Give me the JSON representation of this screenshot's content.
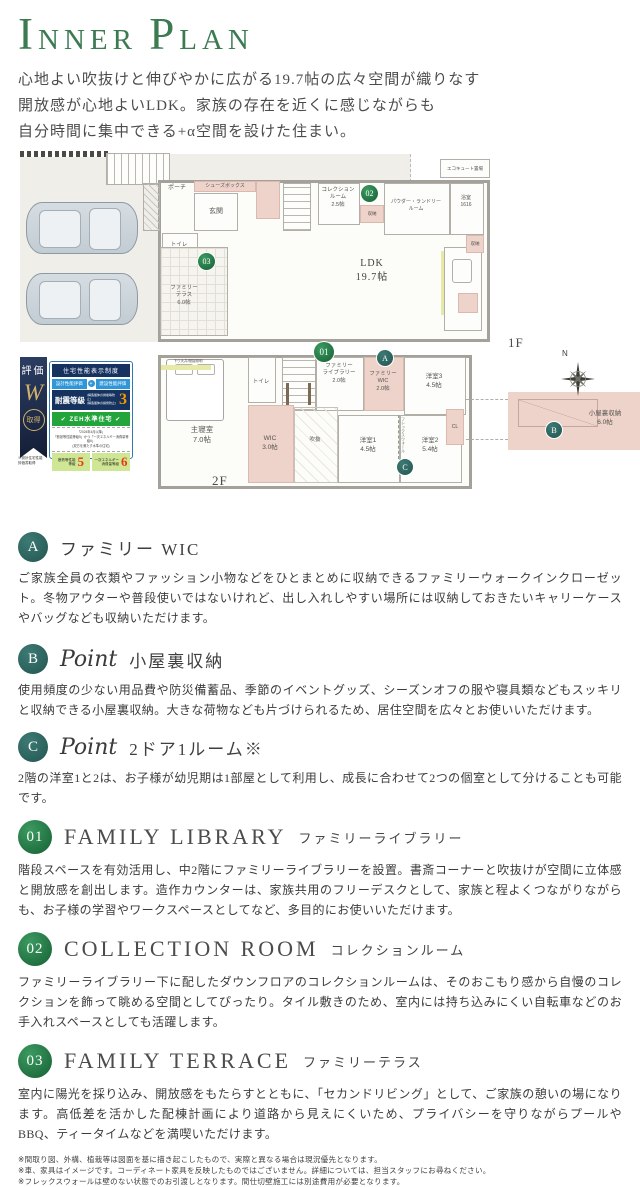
{
  "header": {
    "title_i": "I",
    "title_nner": "NNER",
    "title_p": "P",
    "title_lan": "LAN",
    "description_lines": [
      "心地よい吹抜けと伸びやかに広がる19.7帖の広々空間が織りなす",
      "開放感が心地よいLDK。家族の存在を近くに感じながらも",
      "自分時間に集中できる+α空間を設けた住まい。"
    ]
  },
  "floorplan": {
    "compass_n": "N",
    "markers": {
      "m01": "01",
      "m02": "02",
      "m03": "03",
      "mA": "A",
      "mB": "B",
      "mC": "C"
    },
    "f1": {
      "label": "1F",
      "porch": "ポーチ",
      "shoes": "シューズボックス",
      "entrance": "玄関",
      "toilet": "トイレ",
      "collection": "コレクション\nルーム\n2.5帖",
      "storage1": "収納",
      "powder": "パウダー・ランドリー\nルーム",
      "bath": "浴室\n1616",
      "ecocute": "エコキュート置場",
      "ldk": "LDK\n19.7帖",
      "terrace": "ファミリー\nテラス\n6.0帖",
      "storage2": "収納"
    },
    "f2": {
      "label": "2F",
      "bedroom": "主寝室\n7.0帖",
      "ceiling_note": "下り天井/間接照明",
      "toilet": "トイレ",
      "library": "ファミリー\nライブラリー\n2.0帖",
      "family_wic": "ファミリー\nWIC\n2.0帖",
      "room3": "洋室3\n4.5帖",
      "wic": "WIC\n3.0帖",
      "void": "吹抜",
      "room1": "洋室1\n4.5帖",
      "room2": "洋室2\n5.4帖",
      "closet": "CL",
      "flex_wall": "フレックスウォール",
      "attic": "小屋裏収納\n6.0帖"
    }
  },
  "rating_badge": {
    "ribbon_top": "評価",
    "ribbon_letter": "W",
    "ribbon_bottom": "取得",
    "caption": "※設計住宅性能\n評価書取得",
    "header": "住宅性能表示制度",
    "design_eval": "設計性能評価",
    "plus": "+",
    "construction_eval": "建設性能評価",
    "seismic_label": "耐震等級",
    "seismic_note": "(構造躯体の倒壊等防止)\n(構造躯体の損傷防止)",
    "seismic_value": "3",
    "zeh_label": "✔ ZEH水準住宅 ✔",
    "zeh_note": "「2024年4月以降」\n「断熱等性能等級5」かつ「一次エネルギー消費量等級6」\n(双方を満たす水準の住宅)",
    "insulation_label": "断熱等性能\n等級",
    "insulation_value": "5",
    "energy_label": "一次エネルギー\n消費量等級",
    "energy_value": "6"
  },
  "sections": [
    {
      "marker": "A",
      "title": "ファミリー WIC",
      "body": "ご家族全員の衣類やファッション小物などをひとまとめに収納できるファミリーウォークインクローゼット。冬物アウターや普段使いではないけれど、出し入れしやすい場所には収納しておきたいキャリーケースやバッグなども収納いただけます。"
    },
    {
      "marker": "B",
      "script": "Point",
      "title": "小屋裏収納",
      "body": "使用頻度の少ない用品費や防災備蓄品、季節のイベントグッズ、シーズンオフの服や寝具類などもスッキリと収納できる小屋裏収納。大きな荷物なども片づけられるため、居住空間を広々とお使いいただけます。"
    },
    {
      "marker": "C",
      "script": "Point",
      "title": "2ドア1ルーム※",
      "body": "2階の洋室1と2は、お子様が幼児期は1部屋として利用し、成長に合わせて2つの個室として分けることも可能です。"
    },
    {
      "marker": "01",
      "title_en": "FAMILY LIBRARY",
      "title_jp": "ファミリーライブラリー",
      "body": "階段スペースを有効活用し、中2階にファミリーライブラリーを設置。書斎コーナーと吹抜けが空間に立体感と開放感を創出します。造作カウンターは、家族共用のフリーデスクとして、家族と程よくつながりながらも、お子様の学習やワークスペースとしてなど、多目的にお使いいただけます。"
    },
    {
      "marker": "02",
      "title_en": "COLLECTION ROOM",
      "title_jp": "コレクションルーム",
      "body": "ファミリーライブラリー下に配したダウンフロアのコレクションルームは、そのおこもり感から自慢のコレクションを飾って眺める空間としてぴったり。タイル敷きのため、室内には持ち込みにくい自転車などのお手入れスペースとしても活躍します。"
    },
    {
      "marker": "03",
      "title_en": "FAMILY TERRACE",
      "title_jp": "ファミリーテラス",
      "body": "室内に陽光を採り込み、開放感をもたらすとともに、「セカンドリビング」として、ご家族の憩いの場になります。高低差を活かした配棟計画により道路から見えにくいため、プライバシーを守りながらプールやBBQ、ティータイムなどを満喫いただけます。"
    }
  ],
  "footnotes": [
    "※間取り図、外構、植栽等は図面を基に描き起こしたもので、実際と異なる場合は現況優先となります。",
    "※車、家具はイメージです。コーディネート家具を反映したものではございません。詳細については、担当スタッフにお尋ねください。",
    "※フレックスウォールは壁のない状態でのお引渡しとなります。間仕切壁施工には別途費用が必要となります。"
  ],
  "palette": {
    "title_green": "#3c7a52",
    "marker_green": "#1d7a3e",
    "marker_teal": "#2e6763",
    "room_pink": "#eed3cb",
    "badge_navy": "#16335f",
    "zeh_green": "#23a53c",
    "grade_red": "#e8380d"
  }
}
